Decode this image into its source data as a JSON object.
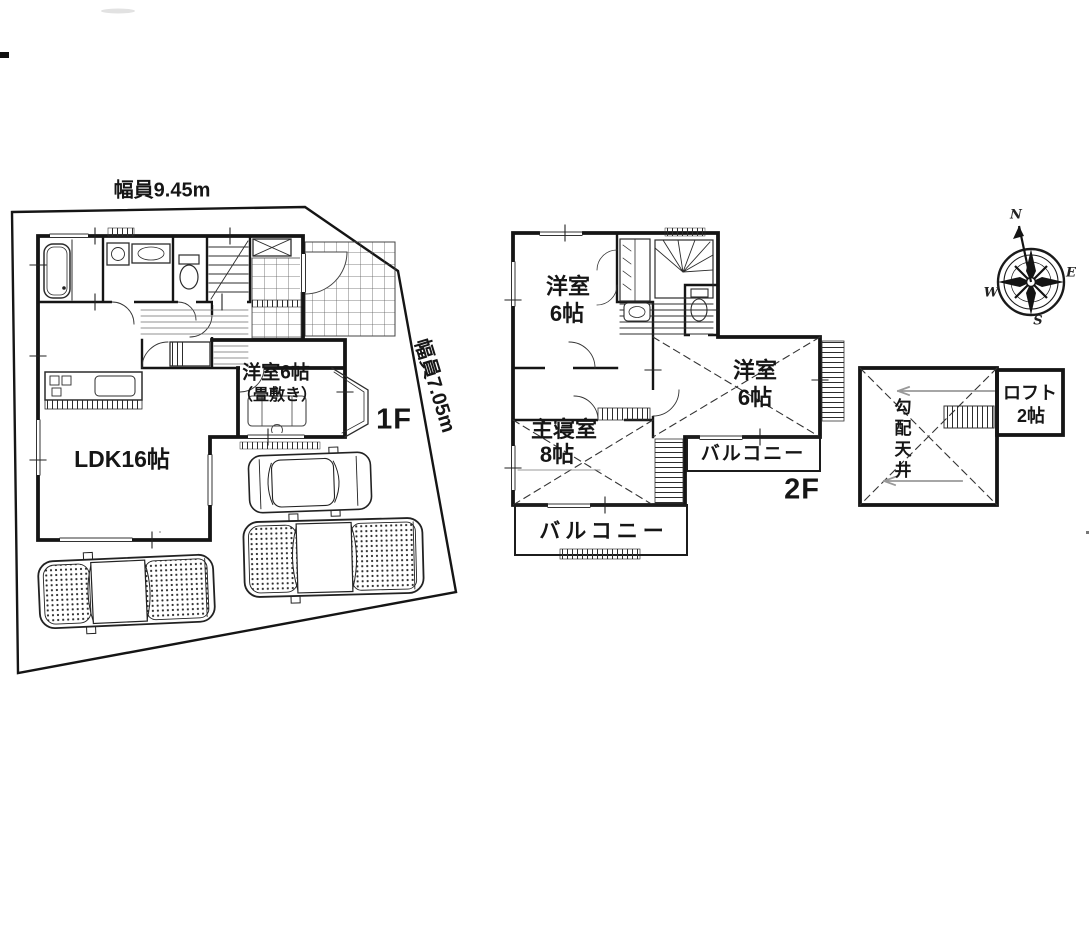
{
  "drawing": {
    "site": {
      "road_width_top": "幅員9.45m",
      "road_width_side": "幅員7.05m"
    },
    "floor1": {
      "label": "1F",
      "ldk": "LDK16帖",
      "western_room": "洋室6帖",
      "western_room_note": "（畳敷き）"
    },
    "floor2": {
      "label": "2F",
      "room_northwest": {
        "name": "洋室",
        "size": "6帖"
      },
      "room_east": {
        "name": "洋室",
        "size": "6帖"
      },
      "master_bedroom": {
        "name": "主寝室",
        "size": "8帖"
      },
      "balcony_east": "バルコニー",
      "balcony_south": "バルコニー"
    },
    "loft": {
      "name": "ロフト",
      "size": "2帖",
      "ceiling_note": "勾配天井"
    },
    "compass": {
      "north": "N",
      "east": "E",
      "west": "W",
      "south": "S"
    }
  }
}
